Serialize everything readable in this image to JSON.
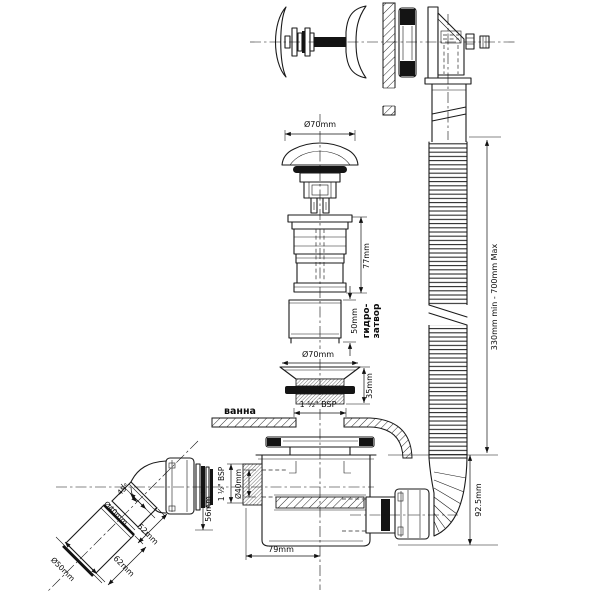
{
  "drawing": {
    "background": "#ffffff",
    "line_color": "#1a1a1a"
  },
  "labels": {
    "bath": "ванна",
    "water_seal_line1": "гидро-",
    "water_seal_line2": "затвор"
  },
  "dimensions": {
    "plug_cap_diameter": "Ø70mm",
    "waste_body_height": "77mm",
    "water_seal_height": "50mm",
    "waste_flange_diameter": "Ø70mm",
    "waste_thread_height": "35mm",
    "waste_thread_size": "1 ½\" BSP",
    "hose_length_range": "330mm min - 700mm Max",
    "tail_height": "92.5mm",
    "inlet_thread_size": "1 ½\" BSP",
    "inlet_diameter": "Ø40mm",
    "trap_depth": "56mm",
    "trap_offset": "79mm",
    "elbow_angle": "45°",
    "elbow_diameter": "Ø40mm",
    "elbow_length_upper": "52mm",
    "elbow_length_lower": "62mm",
    "outlet_diameter": "Ø50mm"
  }
}
